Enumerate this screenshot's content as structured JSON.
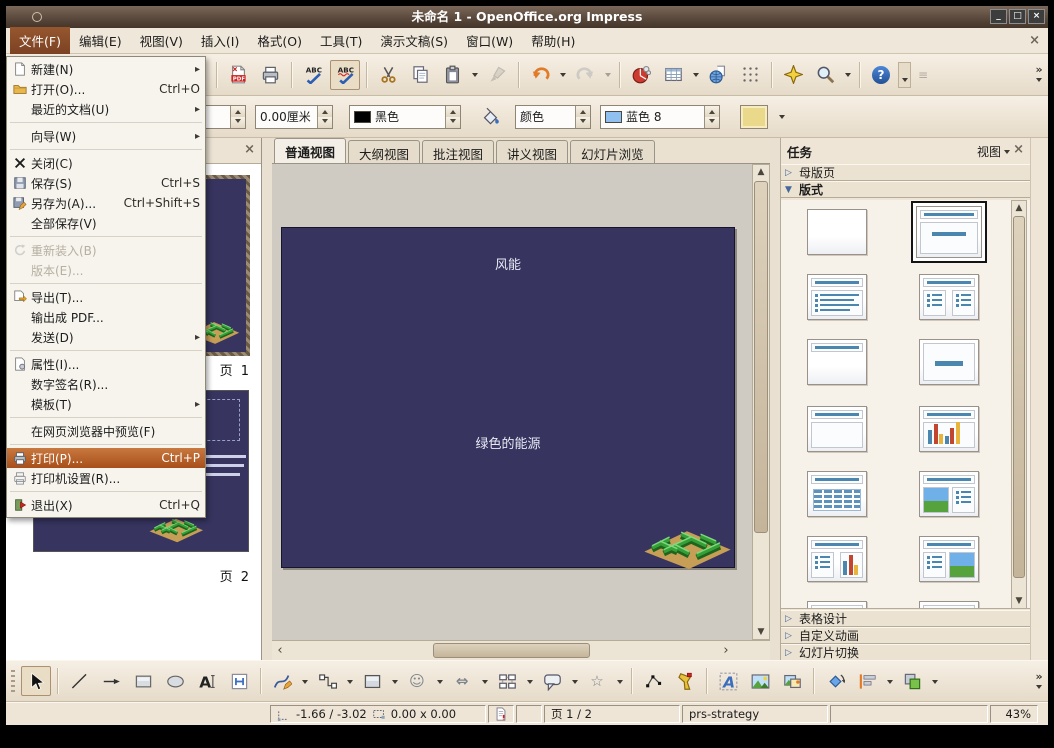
{
  "window": {
    "title": "未命名 1 - OpenOffice.org Impress"
  },
  "glyphs": {
    "minimize": "_",
    "maximize": "□",
    "close": "×",
    "submenu": "▸",
    "overflow": "»",
    "left": "‹",
    "right": "›",
    "up": "▲",
    "down": "▼",
    "smiley": "☺",
    "star": "☆",
    "double_arrow": "⇔",
    "help": "?",
    "lines": "≡",
    "collapsed": "▷",
    "expanded": "▼"
  },
  "menubar": {
    "items": [
      "文件(F)",
      "编辑(E)",
      "视图(V)",
      "插入(I)",
      "格式(O)",
      "工具(T)",
      "演示文稿(S)",
      "窗口(W)",
      "帮助(H)"
    ]
  },
  "file_menu": {
    "items": [
      {
        "label": "新建(N)"
      },
      {
        "label": "打开(O)...",
        "shortcut": "Ctrl+O"
      },
      {
        "label": "最近的文档(U)"
      },
      {
        "label": "向导(W)"
      },
      {
        "label": "关闭(C)"
      },
      {
        "label": "保存(S)",
        "shortcut": "Ctrl+S"
      },
      {
        "label": "另存为(A)...",
        "shortcut": "Ctrl+Shift+S"
      },
      {
        "label": "全部保存(V)"
      },
      {
        "label": "重新装入(B)"
      },
      {
        "label": "版本(E)..."
      },
      {
        "label": "导出(T)..."
      },
      {
        "label": "输出成 PDF..."
      },
      {
        "label": "发送(D)"
      },
      {
        "label": "属性(I)..."
      },
      {
        "label": "数字签名(R)..."
      },
      {
        "label": "模板(T)"
      },
      {
        "label": "在网页浏览器中预览(F)"
      },
      {
        "label": "打印(P)...",
        "shortcut": "Ctrl+P"
      },
      {
        "label": "打印机设置(R)..."
      },
      {
        "label": "退出(X)",
        "shortcut": "Ctrl+Q"
      }
    ]
  },
  "toolbar2": {
    "line_width": "0.00厘米",
    "line_color": "黑色",
    "fill_type": "颜色",
    "fill_color": "蓝色 8"
  },
  "view_tabs": {
    "items": [
      "普通视图",
      "大纲视图",
      "批注视图",
      "讲义视图",
      "幻灯片浏览"
    ]
  },
  "slides": {
    "page1_label": "页 1",
    "page2_label": "页 2"
  },
  "slide": {
    "title": "风能",
    "subtitle": "绿色的能源"
  },
  "task_panel": {
    "title": "任务",
    "view_menu": "视图",
    "master_pages": "母版页",
    "layouts": "版式",
    "table_design": "表格设计",
    "custom_animation": "自定义动画",
    "slide_transition": "幻灯片切换"
  },
  "statusbar": {
    "position": "-1.66 / -3.02",
    "size": "0.00 x 0.00",
    "page": "页 1 / 2",
    "template": "prs-strategy",
    "zoom": "43%"
  }
}
